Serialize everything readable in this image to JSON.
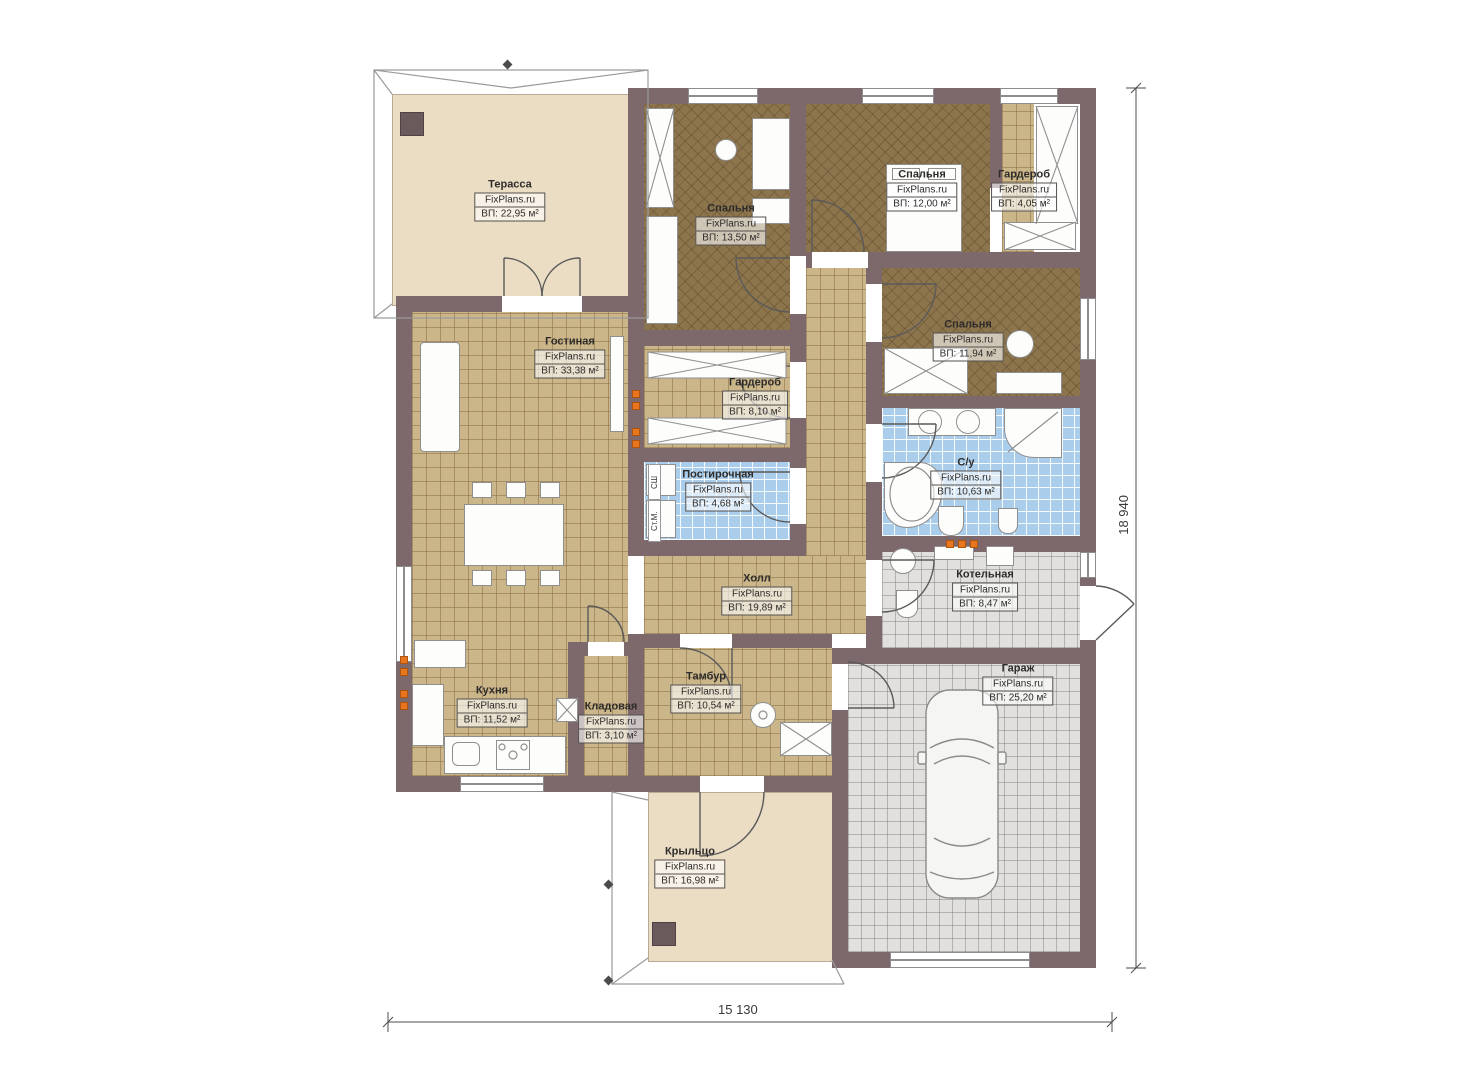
{
  "watermark": "FixPlans.ru",
  "dimensions": {
    "width_label": "15 130",
    "height_label": "18 940"
  },
  "laundry_marks": {
    "dryer": "СШ",
    "washer": "Ст.М."
  },
  "colors": {
    "wall": "#7d696b",
    "tile_tan": "#cbb68a",
    "tile_blue": "#a9cdeb",
    "tile_gray": "#e1e0de",
    "bedroom_floor": "#8c744c",
    "terrace_beige": "#ebdcc4",
    "accent_orange": "#e8761f"
  },
  "rooms": [
    {
      "id": "terrace",
      "name": "Терасса",
      "area": "ВП: 22,95 м²"
    },
    {
      "id": "bedroom-1",
      "name": "Спальня",
      "area": "ВП: 13,50 м²"
    },
    {
      "id": "bedroom-2",
      "name": "Спальня",
      "area": "ВП: 12,00 м²"
    },
    {
      "id": "wardrobe-2",
      "name": "Гардероб",
      "area": "ВП: 4,05 м²"
    },
    {
      "id": "living-room",
      "name": "Гостиная",
      "area": "ВП: 33,38 м²"
    },
    {
      "id": "wardrobe-1",
      "name": "Гардероб",
      "area": "ВП: 8,10 м²"
    },
    {
      "id": "bedroom-3",
      "name": "Спальня",
      "area": "ВП: 11,94 м²"
    },
    {
      "id": "laundry",
      "name": "Постирочная",
      "area": "ВП: 4,68 м²"
    },
    {
      "id": "bathroom",
      "name": "С/у",
      "area": "ВП: 10,63 м²"
    },
    {
      "id": "hall",
      "name": "Холл",
      "area": "ВП: 19,89 м²"
    },
    {
      "id": "boiler-room",
      "name": "Котельная",
      "area": "ВП: 8,47 м²"
    },
    {
      "id": "kitchen",
      "name": "Кухня",
      "area": "ВП: 11,52 м²"
    },
    {
      "id": "pantry",
      "name": "Кладовая",
      "area": "ВП: 3,10 м²"
    },
    {
      "id": "vestibule",
      "name": "Тамбур",
      "area": "ВП: 10,54 м²"
    },
    {
      "id": "garage",
      "name": "Гараж",
      "area": "ВП: 25,20 м²"
    },
    {
      "id": "porch",
      "name": "Крыльцо",
      "area": "ВП: 16,98 м²"
    }
  ]
}
